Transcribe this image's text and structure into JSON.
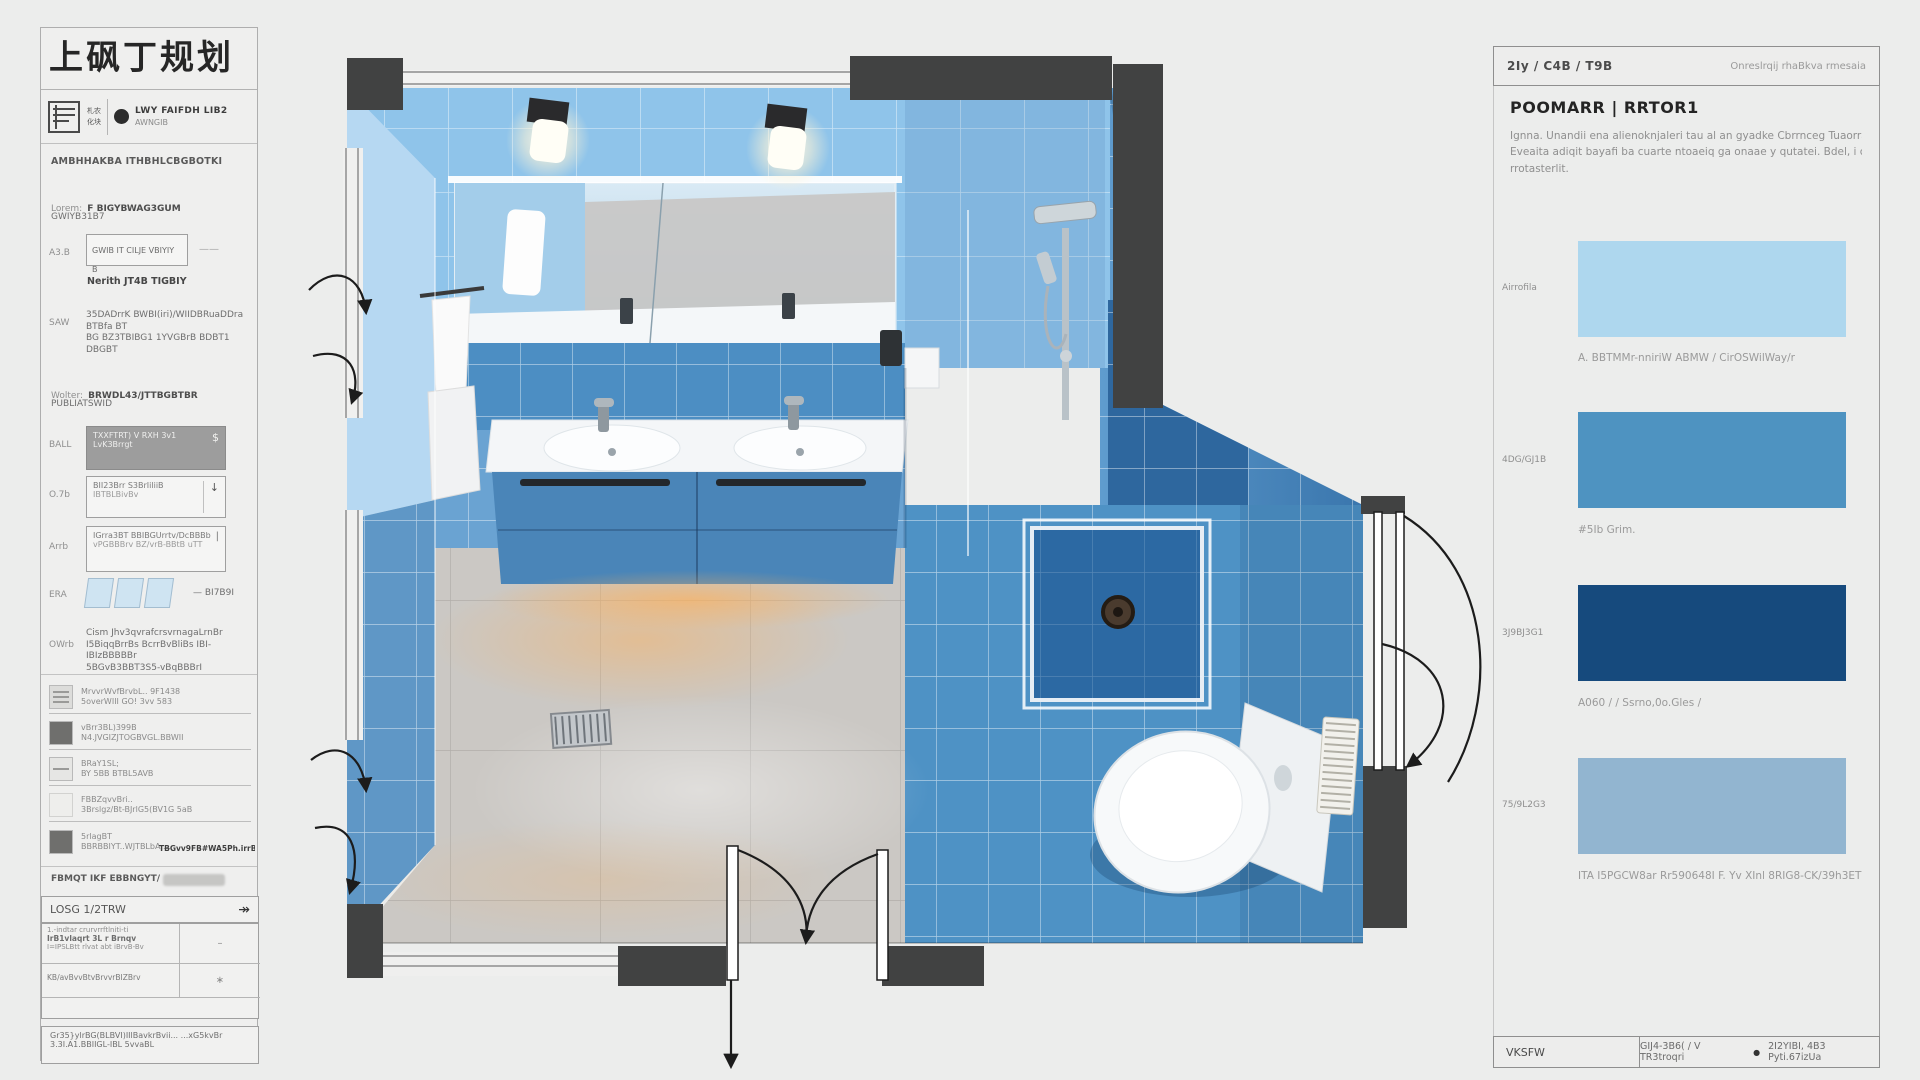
{
  "hdr": {
    "title": "上砜丁规划",
    "logo_mark_1": "札农",
    "logo_mark_2": "化块",
    "dot": "●",
    "line1": "LWY FAIFDH LIB2",
    "line2": "AWNGIB"
  },
  "sb": {
    "intro": "AMBHHAKBA ITHBHLCBGBOTKI",
    "lorem_label": "Lorem:",
    "lorem_value": "F BIGYBWAG3GUM",
    "lorem_sub": "GWIYB31B7",
    "aub_label": "A3.B",
    "aub_value": "GWIB IT CILJE VBIYIY B",
    "aub_dash": "——",
    "aub_note": "Nerith JT4B TIGBIY",
    "saw_label": "SAW",
    "saw_l1": "35DADrrK BWBI(iri)/WIIDBRuaDDra BTBfa BT",
    "saw_l2": "BG BZ3TBIBG1 1YVGBrB BDBT1 DBGBT",
    "wolter_label": "Wolter:",
    "wolter_value": "BRWDL43/JTTBGBTBR",
    "wolter_sub": "PUBLIATSWID",
    "ball_label": "BALL",
    "ball_l1": "TXXFTRT) V RXH 3v1",
    "ball_l2": "LvK3Brrgt",
    "ball_suffix": "$",
    "on_label": "O.7b",
    "on_l1": "BII23Brr S3BrIiliiB",
    "on_l2": "IBTBLBivBv",
    "on_suffix": "↓",
    "ann_label": "Arrb",
    "ann_l1": "IGrra3BT BBIBGUrrtv/DcBBBb",
    "ann_l2": "vPGBBBrv BZ/vrB-BBtB uTT",
    "ann_suffix": "|",
    "era_label": "ERA",
    "era_value": "—  BI7B9I",
    "own_label": "OWrb",
    "own_l1": "Cism Jhv3qvrafcrsvrnagaLrnBr",
    "own_l2": "I5BiqqBrrBs BcrrBvBliBs IBI-IBIzBBBBBr",
    "own_l3": "5BGvB3BBT3S5-vBqBBBrI",
    "r1_l1": "MrvvrWvfBrvbL.. 9F1438",
    "r1_l2": "5overWIII GO! 3vv 583",
    "r2_l1": "vBrr3BL)399B",
    "r2_l2": "N4.JVGIZJTOGBVGL.BBWII",
    "r3_l1": "BRaY1SL;",
    "r3_l2": "BY 5BB BTBL5AVB",
    "r4_l1": "FBBZqvvBri..",
    "r4_l2": "3Brslgz/Bt-BJrlG5(BV1G 5aB",
    "r5_l1": "5rlagBT",
    "r5_l2": "BBRBBIYT..WJTBLbA,...",
    "r5_right": "TBGvv9FB#WA5Ph.irrBF",
    "fbiyit": "FBMQT IKF EBBNGYT/",
    "losg": "LOSG 1/2TRW",
    "losg_icon": "↠",
    "t_r1_l1": "1.-indtar crurvrrftlniti-ti",
    "t_r1_l2": "IrB1vlaqrt 3L r Brnqv",
    "t_r1_l3": "I=IPSLBtt rlvat abt iBrvB-Bv",
    "t_r1_v": "–",
    "t_r2_l1": "KB/avBvvBtvBrvvrBIZBrv",
    "t_r2_v": "∗",
    "foot_l1": "Gr35}ylrBG(BLBVI)IIlBavkrBvii...  ...xG5kvBr",
    "foot_l2": "3.3I.A1.BBIIGL-IBL 5vvaBL"
  },
  "rp": {
    "breadcrumb": "2Iy / C4B / T9B",
    "header_right": "Onreslrqij rhaBkva rmesaia",
    "heading": "POOMARR | RRTOR1",
    "para_l1": "Ignna. Unandii ena alienoknjaleri tau al an gyadke Cbrrnceg Tuaorraiseg fi-aertuer",
    "para_l2": "Eveaita adiqit bayafi ba cuarte ntoaeiq ga onaae y qutatei. Bdel, i caaioorajGeoea..",
    "para_l3": "rrotasterlit.",
    "swatches": [
      {
        "label": "Airrofila",
        "color": "#aed7ee",
        "caption": "A. BBTMMr-nniriW ABMW / CirOSWilWay/r"
      },
      {
        "label": "4DG/GJ1B",
        "color": "#4e93c1",
        "caption": "#5Ib Grim."
      },
      {
        "label": "3J9BJ3G1",
        "color": "#164a7d",
        "caption": "A060 / / Ssrno,0o.Gles /"
      },
      {
        "label": "75/9L2G3",
        "color": "#92b5d0",
        "caption": "ITA I5PGCW8ar Rr590648I F. Yv XInl 8RIG8-CK/39h3ET"
      }
    ],
    "footer_left": "VKSFW",
    "footer_a": "GIJ4-3B6( / V TR3troqri",
    "footer_dot": "●",
    "footer_b": "2I2YIBI, 4B3 Pyti.67izUa"
  },
  "palette": {
    "back_wall_blue": "#8fc4ea",
    "left_wall_blue": "#b6d8f2",
    "tile_band_blue": "#4c8ec3",
    "right_wall_blue": "#4a86ba",
    "shower_navy": "#2e679e",
    "floor_blue": "#4e92c5",
    "floor_gray": "#cbc8c4",
    "plan_wall_dark": "#414242",
    "page_bg": "#ecedec"
  }
}
